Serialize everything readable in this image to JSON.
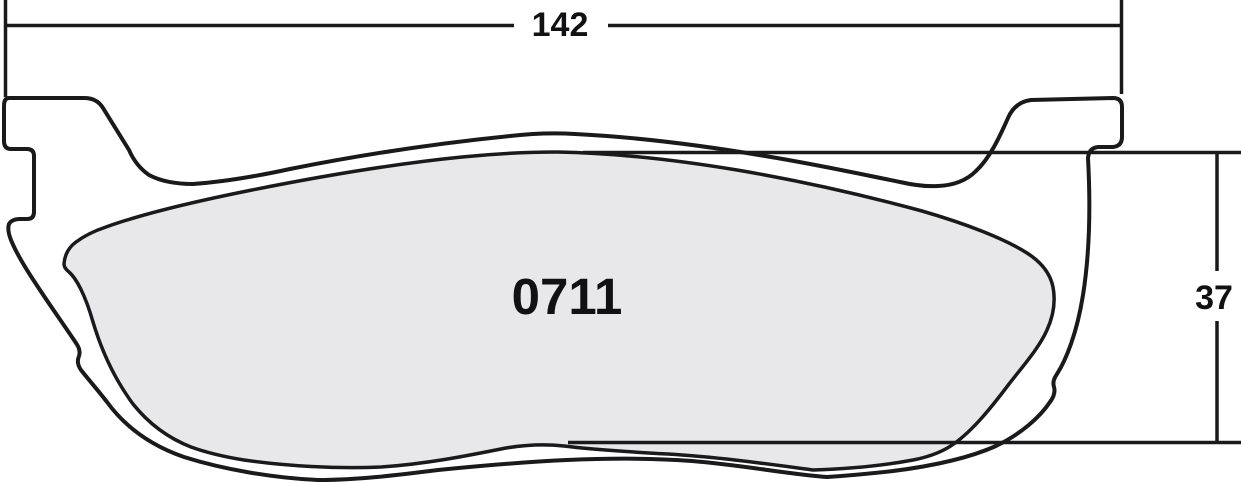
{
  "drawing": {
    "part_number": "0711",
    "width_dimension": "142",
    "height_dimension": "37"
  },
  "colors": {
    "line": "#1a1a1c",
    "friction_fill": "#e8e8ea",
    "background": "#ffffff"
  }
}
